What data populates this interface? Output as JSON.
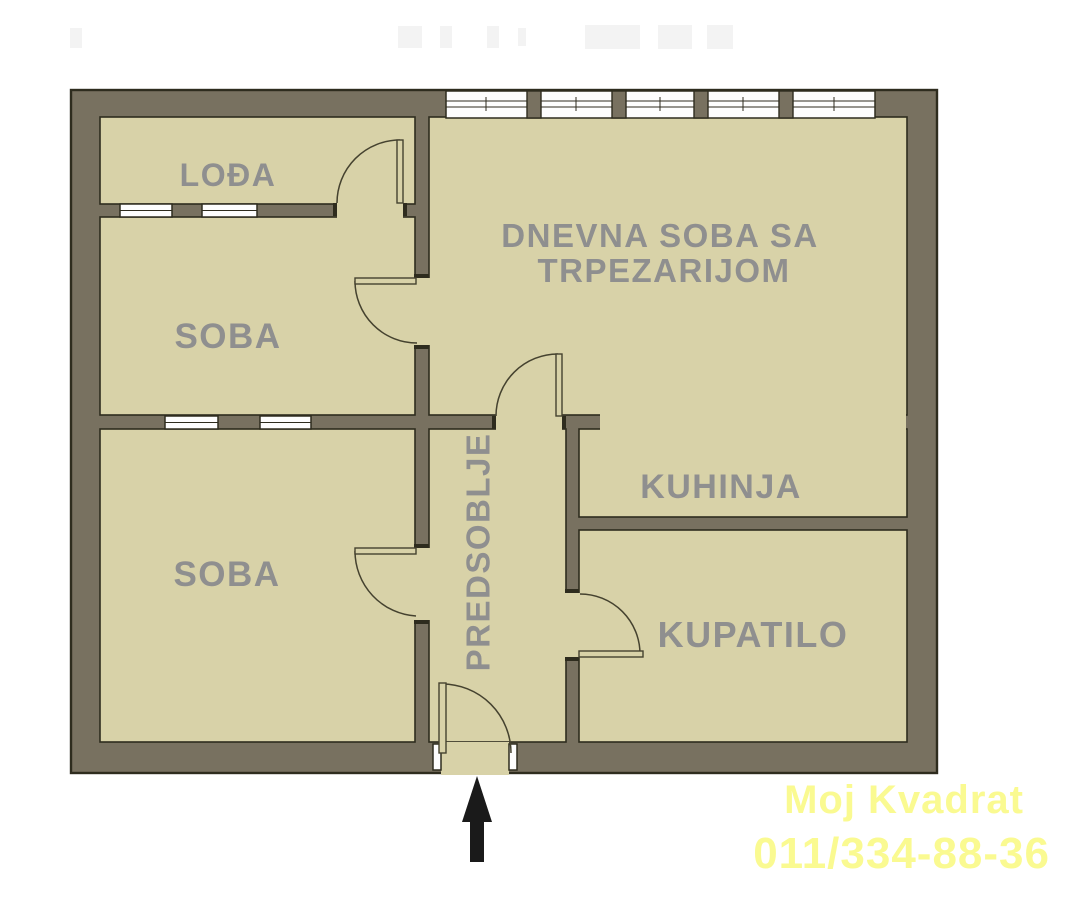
{
  "plan": {
    "rooms": {
      "loda": {
        "label": "LOĐA"
      },
      "soba_top": {
        "label": "SOBA"
      },
      "soba_bottom": {
        "label": "SOBA"
      },
      "dnevna": {
        "label_line1": "DNEVNA SOBA SA",
        "label_line2": "TRPEZARIJOM"
      },
      "kuhinja": {
        "label": "KUHINJA"
      },
      "predsoblje": {
        "label": "PREDSOBLJE"
      },
      "kupatilo": {
        "label": "KUPATILO"
      }
    },
    "features": {
      "doors": [
        "loggia-door",
        "top-room-door",
        "bottom-room-door",
        "living-room-door",
        "bathroom-door",
        "entrance-door"
      ],
      "windows": [
        "facade-window-band",
        "loggia-wall-window-1",
        "loggia-wall-window-2",
        "room-divider-window-1",
        "room-divider-window-2"
      ],
      "entrance_marker": "up-arrow"
    }
  },
  "watermark": {
    "line1": "Moj Kvadrat",
    "line2": "011/334-88-36"
  },
  "colors": {
    "floor": "#d8d2a8",
    "wall": "#787160",
    "outline": "#2e2c1e",
    "line": "#45422f",
    "label": "#8f8f8f",
    "window": "#fdfdfd",
    "arrow": "#1a1a1a",
    "watermark": "#fafa91",
    "background": "#ffffff"
  }
}
